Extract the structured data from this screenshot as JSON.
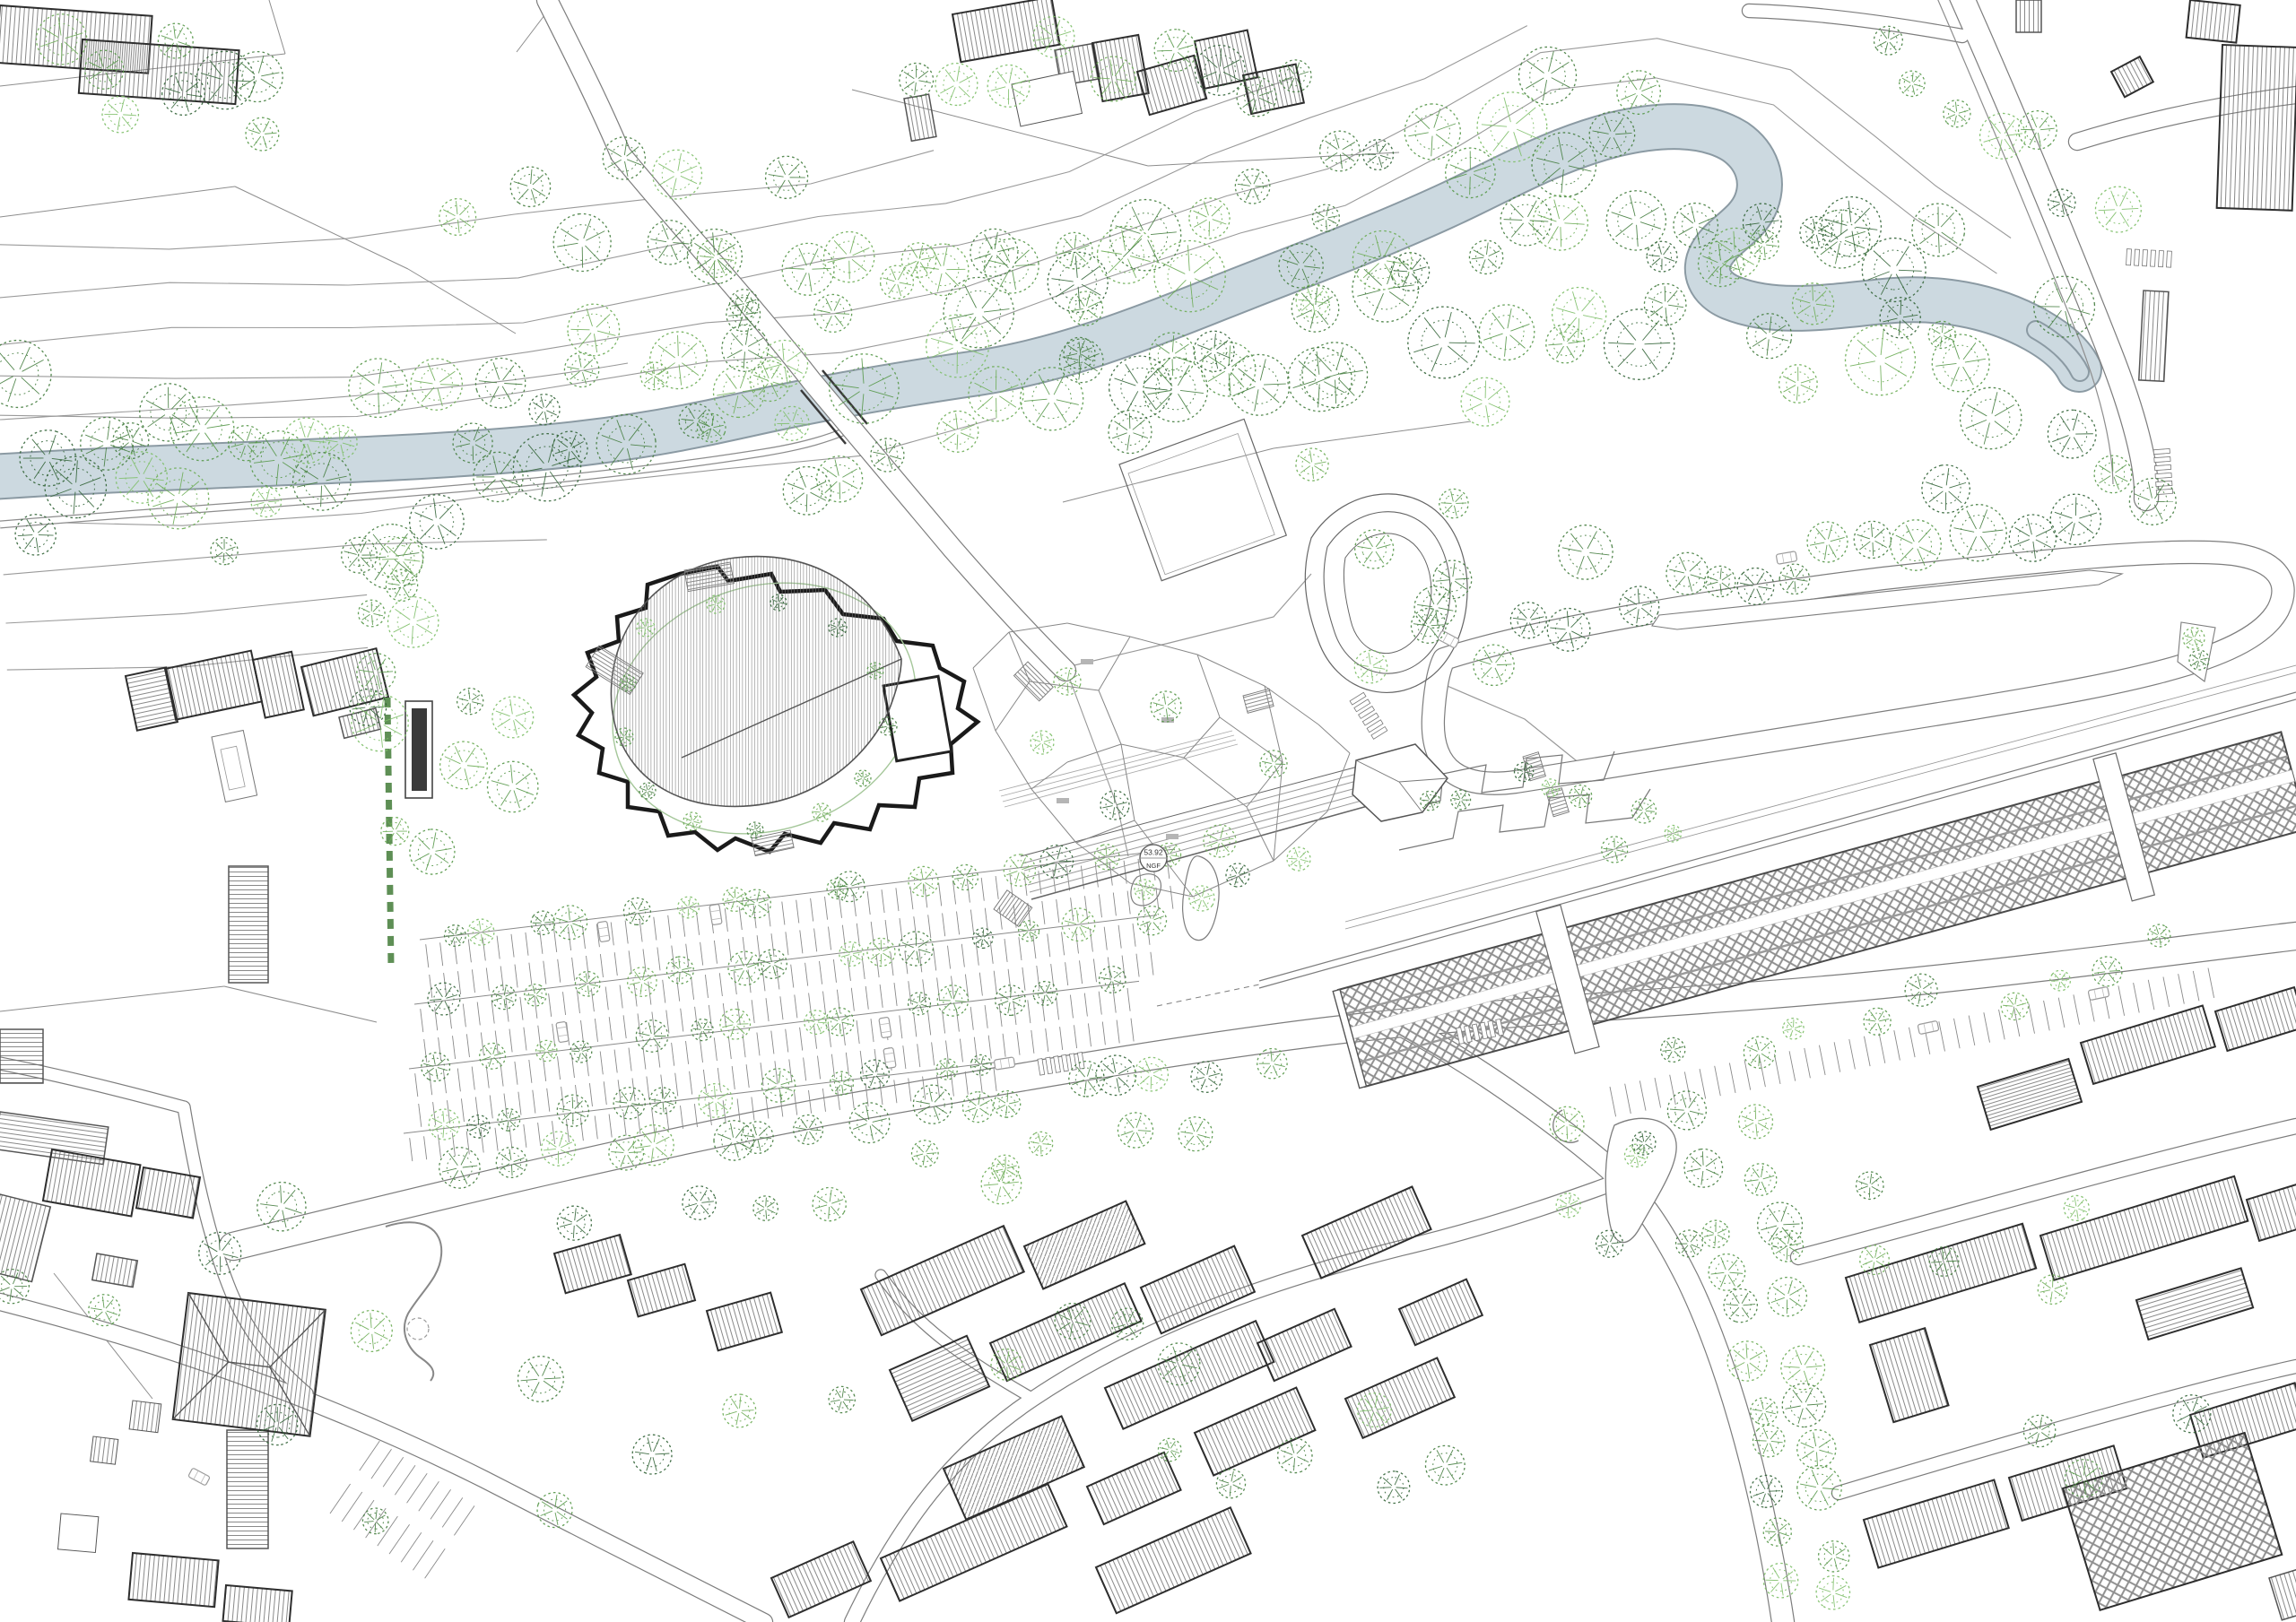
{
  "map": {
    "kind": "architectural-masterplan-site-plan",
    "view": "top-down orthographic line drawing",
    "annotations": {
      "level_marker": {
        "value": "53.92",
        "datum": "NGF"
      }
    },
    "palette": {
      "paper": "#ffffff",
      "river_fill": "#ccd9e0",
      "river_edge": "#8b9aa3",
      "contour_line": "#9a9a9a",
      "road_edge": "#7d7d7d",
      "building_outline": "#2e2e2e",
      "context_outline": "#555555",
      "roof_hatch": "#6b6b6b",
      "station_lattice": "#8f8f8f",
      "stair_fill": "#9a9a9a",
      "plaza_ring_line": "#a5c79a",
      "tree_palette": [
        "#6fae58",
        "#58994b",
        "#477f42",
        "#35663a",
        "#7fbf6a"
      ]
    }
  }
}
